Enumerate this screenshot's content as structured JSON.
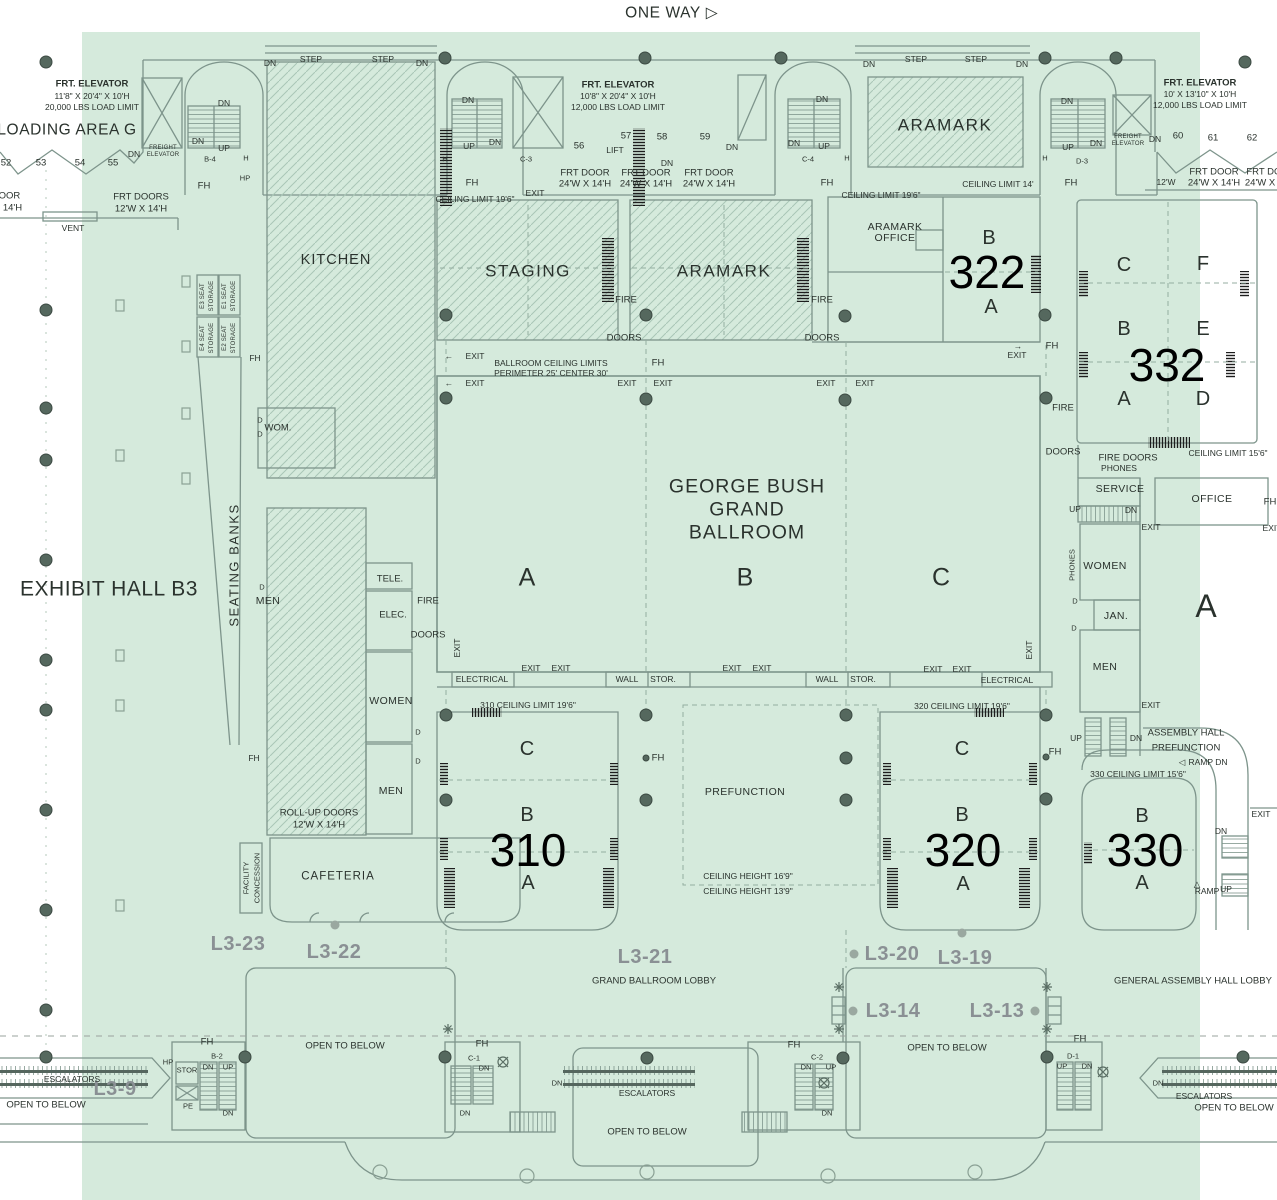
{
  "c": {
    "dn": "DN",
    "up": "UP",
    "exit": "EXIT",
    "fh": "FH",
    "d": "D",
    "h": "H",
    "hp": "HP",
    "step": "STEP",
    "fire": "FIRE",
    "doors": "DOORS",
    "fire_doors": "FIRE DOORS",
    "phones": "PHONES",
    "frt_door": "FRT DOOR",
    "door_24": "24'W X 14'H",
    "size_12w": "12'W X 14'H",
    "escalators": "ESCALATORS",
    "open_below": "OPEN TO BELOW",
    "ceil_196": "CEILING LIMIT 19'6\"",
    "wall": "WALL",
    "stor": "STOR.",
    "freight_1": "FREIGHT",
    "freight_2": "ELEVATOR",
    "women": "WOMEN",
    "men": "MEN",
    "aramark": "ARAMARK",
    "frt_elevator": "FRT. ELEVATOR",
    "load_12000": "12,000 LBS LOAD LIMIT"
  },
  "letters": {
    "a": "A",
    "b": "B",
    "c": "C",
    "d": "D",
    "e": "E",
    "f": "F"
  },
  "icons": {
    "one_way_arrow": "▷",
    "arrow_left": "←",
    "arrow_right": "→",
    "ramp_dn_tri": "◁",
    "ramp_up_tri": "△"
  },
  "top_left": {
    "dims": "11'8\" X 20'4\" X 10'H",
    "load": "20,000 LBS LOAD LIMIT",
    "loading": "LOADING AREA G",
    "frt_doors": "FRT DOORS",
    "vent": "VENT",
    "b4": "B-4",
    "c52": "52",
    "c53": "53",
    "c54": "54",
    "c55": "55",
    "door_part": "DOOR",
    "size_part": "X 14'H"
  },
  "top_center": {
    "one_way": "ONE WAY",
    "dims": "10'8\" X 20'4\" X 10'H",
    "lift": "LIFT",
    "c3": "C-3",
    "c4": "C-4",
    "c56": "56",
    "c57": "57",
    "c58": "58",
    "c59": "59"
  },
  "top_right": {
    "dims": "10' X 13'10\" X 10'H",
    "ceil_14": "CEILING LIMIT 14'",
    "d3": "D-3",
    "w12": "12'W",
    "c60": "60",
    "c61": "61",
    "c62": "62"
  },
  "mid": {
    "staging": "STAGING",
    "office": "OFFICE",
    "r322": "322",
    "r332": "332",
    "ceil_156": "CEILING LIMIT 15'6\"",
    "service": "SERVICE",
    "jan": "JAN.",
    "bcl1": "BALLROOM CEILING LIMITS",
    "bcl2": "PERIMETER 25'  CENTER 30'",
    "gb1": "GEORGE BUSH",
    "gb2": "GRAND",
    "gb3": "BALLROOM",
    "electrical": "ELECTRICAL"
  },
  "left": {
    "exhibit": "EXHIBIT HALL B3",
    "seating": "SEATING BANKS",
    "kitchen": "KITCHEN",
    "tele": "TELE.",
    "elec": "ELEC.",
    "wom": "WOM.",
    "e1": "E1 SEAT",
    "e2": "E2 SEAT",
    "e3": "E3 SEAT",
    "e4": "E4 SEAT",
    "storage": "STORAGE"
  },
  "lower": {
    "r310": "310",
    "r320": "320",
    "r330": "330",
    "prefunction": "PREFUNCTION",
    "ceil310": "310 CEILING LIMIT 19'6\"",
    "ceil320": "320 CEILING LIMIT 19'6\"",
    "ceil330": "330 CEILING LIMIT 15'6\"",
    "ch169": "CEILING HEIGHT 16'9\"",
    "ch139": "CEILING HEIGHT 13'9\"",
    "rollup": "ROLL-UP DOORS",
    "cafeteria": "CAFETERIA",
    "facility": "FACILITY",
    "concession": "CONCESSION",
    "ahp1": "ASSEMBLY HALL",
    "ramp_dn": "RAMP DN",
    "ramp": "RAMP"
  },
  "lobby": {
    "l3_9": "L3-9",
    "l3_13": "L3-13",
    "l3_14": "L3-14",
    "l3_19": "L3-19",
    "l3_20": "L3-20",
    "l3_21": "L3-21",
    "l3_22": "L3-22",
    "l3_23": "L3-23",
    "grand_lobby": "GRAND BALLROOM LOBBY",
    "general_lobby": "GENERAL ASSEMBLY HALL LOBBY",
    "b2": "B-2",
    "c1": "C-1",
    "c2": "C-2",
    "d1": "D-1",
    "stor2": "STOR",
    "pe": "PE"
  },
  "colors": {
    "highlight": "#d5eadc",
    "wall": "#7d948b",
    "lobby_label": "#8a9094"
  }
}
